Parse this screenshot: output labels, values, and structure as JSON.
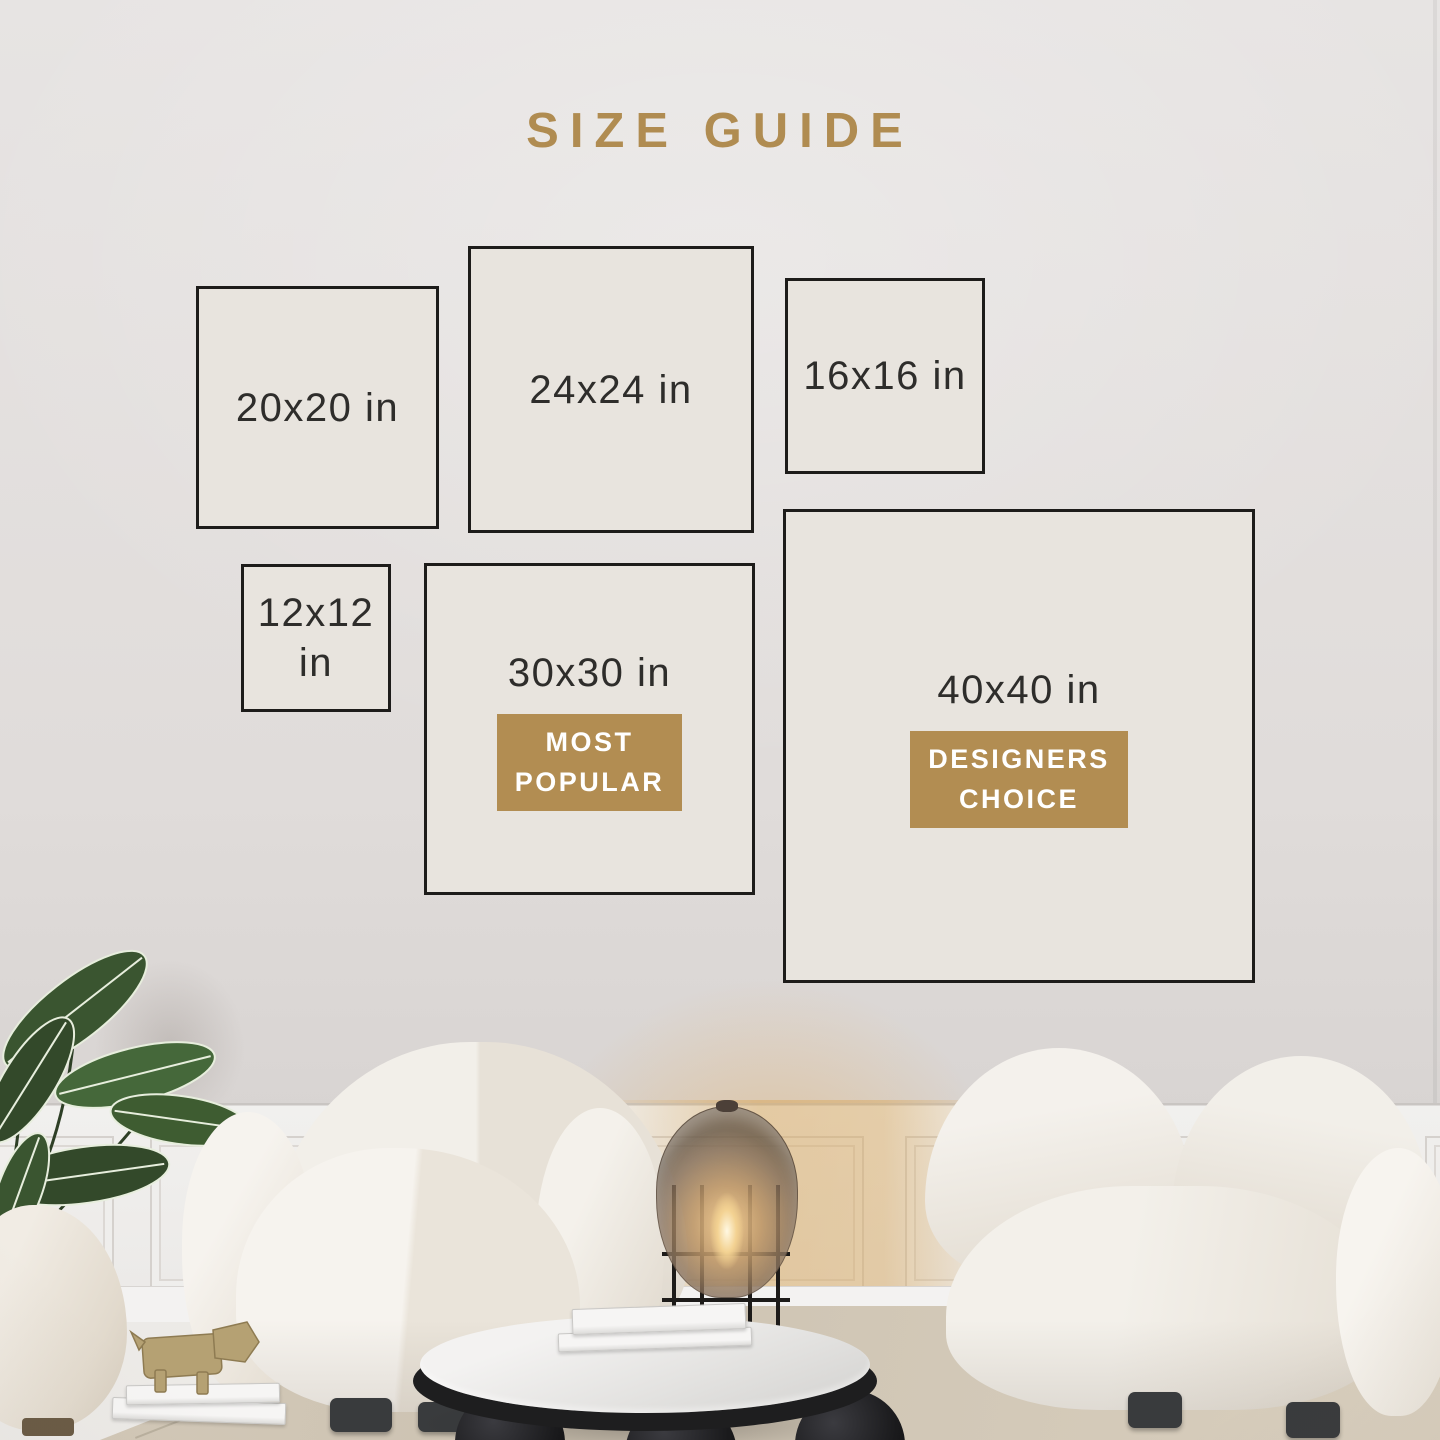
{
  "title": "SIZE GUIDE",
  "colors": {
    "accent_gold": "#b08c51",
    "badge_background": "#b28d52",
    "badge_text": "#ffffff",
    "box_border": "#1d1c1a",
    "box_fill": "#e8e4de",
    "label_text": "#2e2d2b",
    "wall": "#e0dcda",
    "rug": "#cfc5b4"
  },
  "sizes": {
    "s20": {
      "label": "20x20 in"
    },
    "s24": {
      "label": "24x24 in"
    },
    "s16": {
      "label": "16x16 in"
    },
    "s12": {
      "label": "12x12\nin"
    },
    "s30": {
      "label": "30x30 in",
      "badge": "MOST\nPOPULAR"
    },
    "s40": {
      "label": "40x40 in",
      "badge": "DESIGNERS\nCHOICE"
    }
  },
  "scene": {
    "objects": [
      "banana-leaf-plant",
      "boucle-pouf",
      "boucle-armchair",
      "amber-glass-floor-lamp",
      "boucle-sofa",
      "marble-coffee-table",
      "stacked-books",
      "wooden-animal-figurine"
    ]
  }
}
